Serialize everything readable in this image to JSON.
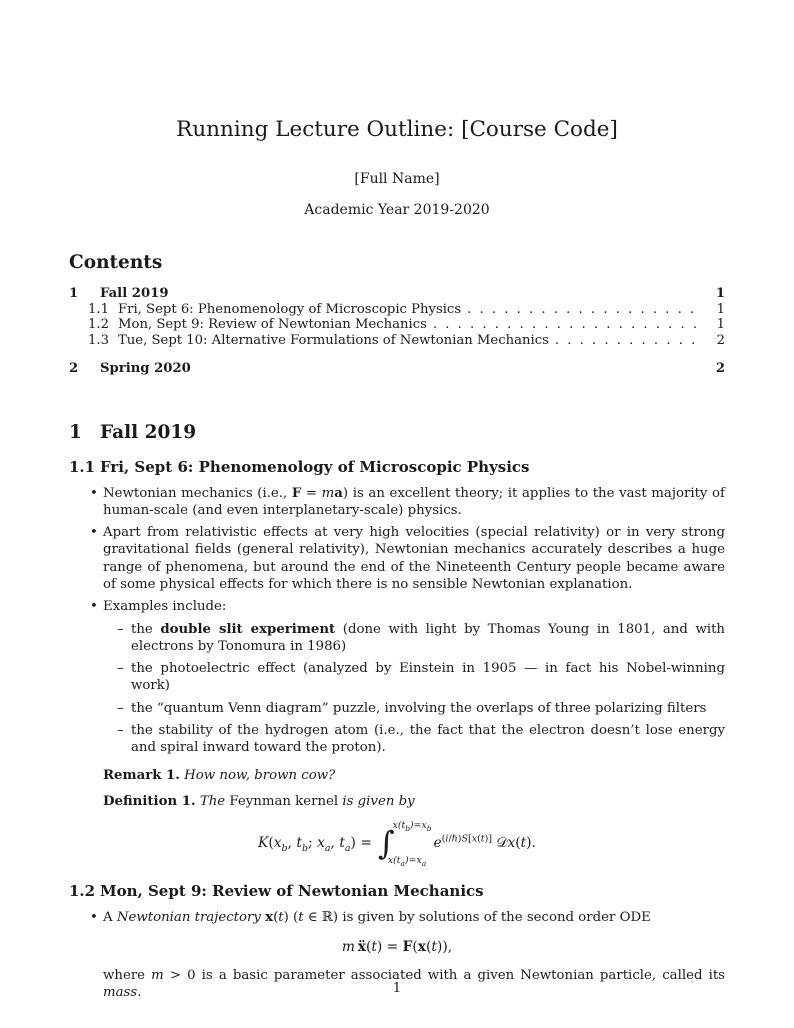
{
  "doc": {
    "title": "Running Lecture Outline: [Course Code]",
    "author": "[Full Name]",
    "date": "Academic Year 2019-2020",
    "footer_page_number": "1"
  },
  "toc": {
    "heading": "Contents",
    "entries": [
      {
        "num": "1",
        "label": "Fall 2019",
        "page": "1"
      },
      {
        "num": "1.1",
        "label": "Fri, Sept 6: Phenomenology of Microscopic Physics",
        "page": "1"
      },
      {
        "num": "1.2",
        "label": "Mon, Sept 9: Review of Newtonian Mechanics",
        "page": "1"
      },
      {
        "num": "1.3",
        "label": "Tue, Sept 10: Alternative Formulations of Newtonian Mechanics",
        "page": "2"
      },
      {
        "num": "2",
        "label": "Spring 2020",
        "page": "2"
      }
    ]
  },
  "section1": {
    "num": "1",
    "title": "Fall 2019",
    "sub1": {
      "num": "1.1",
      "title": "Fri, Sept 6: Phenomenology of Microscopic Physics",
      "bullets": [
        "Newtonian mechanics (i.e., <b>F</b> = <i>m</i><b>a</b>) is an excellent theory; it applies to the vast majority of human-scale (and even interplanetary-scale) physics.",
        "Apart from relativistic effects at very high velocities (special relativity) or in very strong gravitational fields (general relativity), Newtonian mechanics accurately describes a huge range of phenomena, but around the end of the Nineteenth Century people became aware of some physical effects for which there is no sensible Newtonian explanation.",
        "Examples include:"
      ],
      "subbullets": [
        "the <b>double slit experiment</b> (done with light by Thomas Young in 1801, and with electrons by Tonomura in 1986)",
        "the photoelectric effect (analyzed by Einstein in 1905 — in fact his Nobel-winning work)",
        "the “quantum Venn diagram” puzzle, involving the overlaps of three polarizing filters",
        "the stability of the hydrogen atom (i.e., the fact that the electron doesn’t lose energy and spiral inward toward the proton)."
      ],
      "remark": "<b>Remark 1.</b> <i>How now, brown cow?</i>",
      "definition": "<b>Definition 1.</b> <i>The </i>Feynman kernel<i> is given by</i>",
      "kernel_formula": {
        "lhs": "<i>K</i>(<i>x<sub>b</sub></i>, <i>t<sub>b</sub></i>; <i>x<sub>a</sub></i>, <i>t<sub>a</sub></i>) =",
        "integral_sign": "∫",
        "upper_limit": "<i>x</i>(<i>t<sub>b</sub></i>)=<i>x<sub>b</sub></i>",
        "lower_limit": "<i>x</i>(<i>t<sub>a</sub></i>)=<i>x<sub>a</sub></i>",
        "integrand": "<i>e</i><sup>(<i>i</i>/ℏ)<i>S</i>[<i>x</i>(<i>t</i>)]</sup>&nbsp;𝒟<i>x</i>(<i>t</i>)."
      }
    },
    "sub2": {
      "num": "1.2",
      "title": "Mon, Sept 9: Review of Newtonian Mechanics",
      "bullet": "A <i>Newtonian trajectory</i> <b>x</b>(<i>t</i>) (<i>t</i> ∈ ℝ) is given by solutions of the second order ODE",
      "ode_formula": "<i>m</i>&#8201;<b>ẍ</b>(<i>t</i>) = <b>F</b>(<b>x</b>(<i>t</i>)),",
      "continuation": "where <i>m</i> &gt; 0 is a basic parameter associated with a given Newtonian particle, called its <i>mass</i>."
    }
  }
}
